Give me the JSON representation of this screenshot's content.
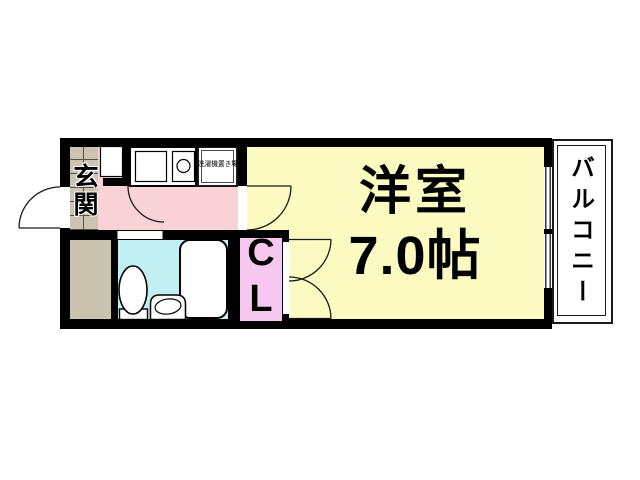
{
  "rooms": {
    "entrance": {
      "label": "玄関",
      "tile_color": "#CBC4B0"
    },
    "kitchen": {
      "washer_label": "洗濯機置き場",
      "floor_color": "#F8D2D6"
    },
    "storage": {
      "floor_color": "#C9C2AE"
    },
    "bathroom": {
      "floor_color": "#C2F0F2"
    },
    "closet": {
      "label": "CL",
      "floor_color": "#F7C8EF"
    },
    "main_room": {
      "name": "洋室",
      "area": "7.0帖",
      "floor_color": "#FBFBC1"
    },
    "balcony": {
      "label": "バルコニー",
      "floor_color": "#FFFFFF"
    }
  },
  "wall_color": "#000000"
}
